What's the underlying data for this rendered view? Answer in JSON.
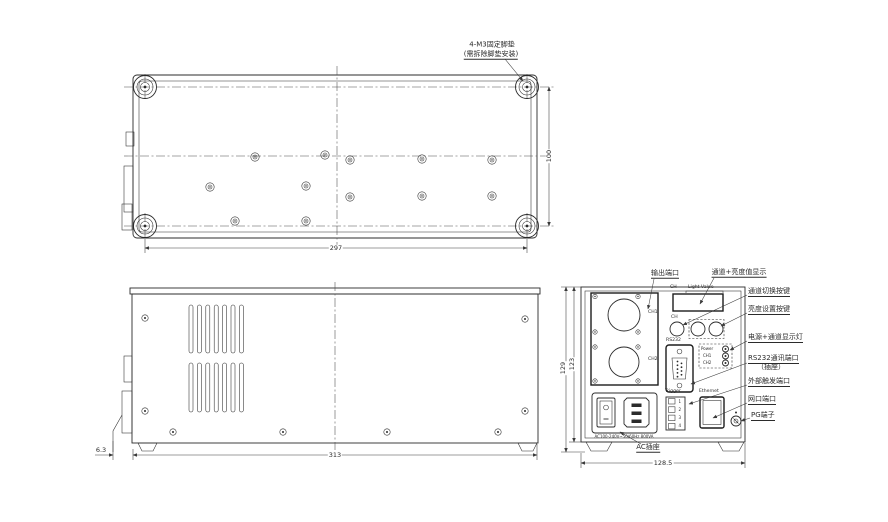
{
  "views": {
    "top": {
      "note_line1": "4-M3固定脚垫",
      "note_line2": "(需拆除脚垫安装)",
      "dims": {
        "width": "297",
        "height": "100"
      }
    },
    "side": {
      "dims": {
        "width": "313",
        "offset": "6.3"
      }
    },
    "rear": {
      "dims": {
        "height_outer": "129",
        "height_inner": "123",
        "width": "128.5"
      },
      "panel": {
        "output_ch1": "CH1",
        "output_ch2": "CH2",
        "display_ch": "CH",
        "display_light_value": "Light Value",
        "button_ch": "CH",
        "rs232": "RS232",
        "led_power": "Power",
        "led_ch1": "CH1",
        "led_ch2": "CH2",
        "trigger": "Trigger",
        "trigger_pins": [
          "1",
          "2",
          "3",
          "4"
        ],
        "ethernet": "Ethernet",
        "ac_rating": "AC100-240V~50/60Hz 800VA"
      },
      "annotations": {
        "output_port": "输出端口",
        "display": "通道+亮度值显示",
        "channel_switch": "通道切换按键",
        "brightness_set": "亮度设置按键",
        "power_leds": "电源+通道显示灯",
        "rs232_line1": "RS232通讯端口",
        "rs232_line2": "（插座）",
        "ext_trigger": "外部触发端口",
        "lan_port": "网口端口",
        "pg_terminal": "PG端子",
        "ac_socket": "AC插座"
      }
    }
  }
}
